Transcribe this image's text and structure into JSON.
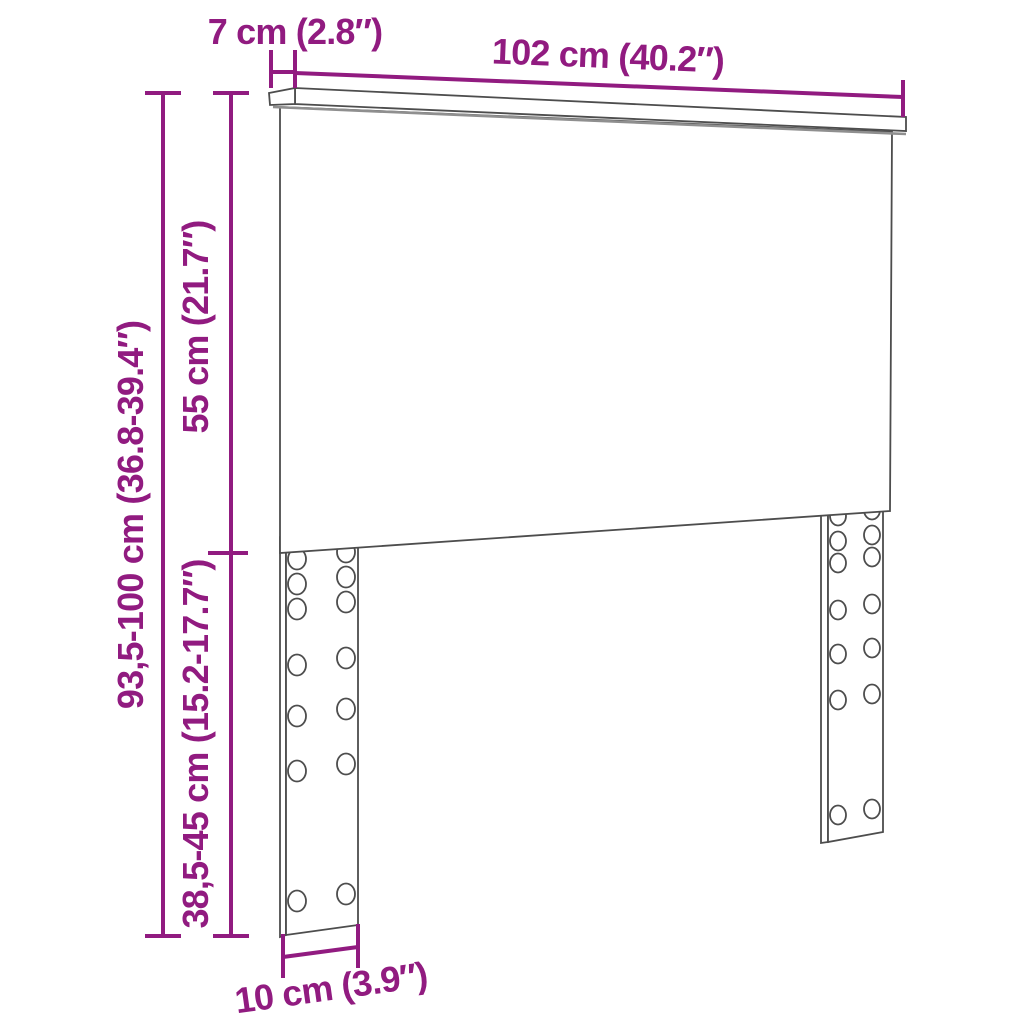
{
  "dimensions": {
    "top_depth": "7 cm (2.8″)",
    "width": "102 cm (40.2″)",
    "total_height": "93,5-100 cm (36.8-39.4″)",
    "board_height": "55 cm (21.7″)",
    "leg_height": "38,5-45 cm (15.2-17.7″)",
    "leg_width": "10 cm (3.9″)"
  },
  "colors": {
    "dimension_accent": "#911B80",
    "drawing_outline": "#4D4D4D",
    "background": "#FFFFFF"
  }
}
